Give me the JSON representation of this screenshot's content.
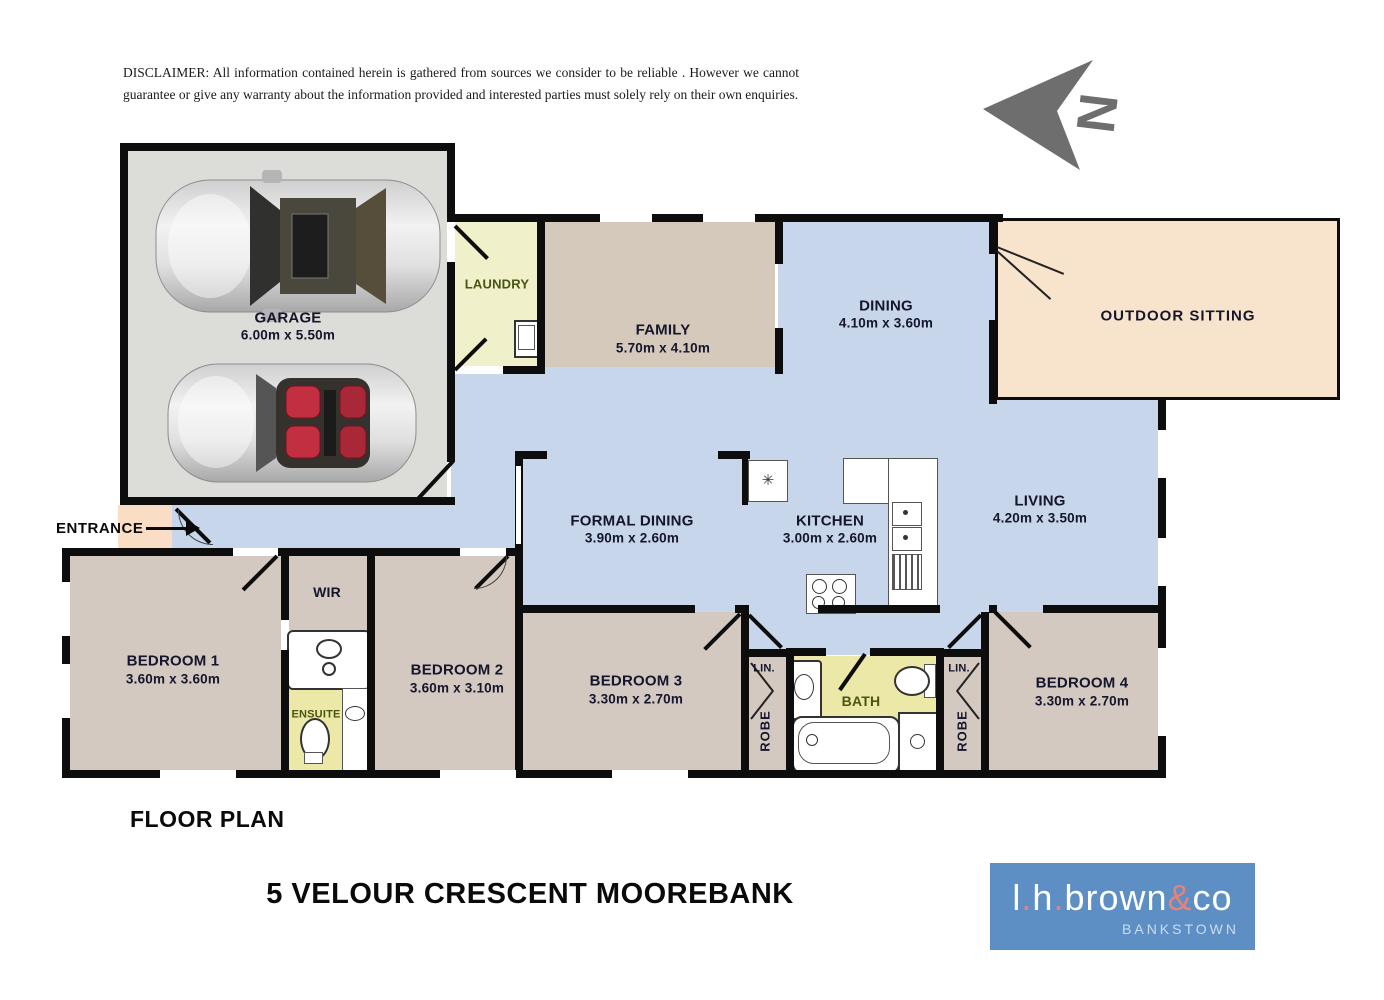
{
  "disclaimer": {
    "text": "DISCLAIMER:  All information contained herein is gathered from sources we consider to be reliable . However we cannot guarantee or give any warranty about the information provided and interested parties must solely rely on their own enquiries."
  },
  "north": {
    "label": "N"
  },
  "rooms": {
    "garage": {
      "name": "GARAGE",
      "dims": "6.00m x 5.50m"
    },
    "laundry": {
      "name": "LAUNDRY"
    },
    "family": {
      "name": "FAMILY",
      "dims": "5.70m x 4.10m"
    },
    "dining": {
      "name": "DINING",
      "dims": "4.10m x 3.60m"
    },
    "outdoor": {
      "name": "OUTDOOR SITTING"
    },
    "living": {
      "name": "LIVING",
      "dims": "4.20m x 3.50m"
    },
    "formal_dining": {
      "name": "FORMAL DINING",
      "dims": "3.90m x 2.60m"
    },
    "kitchen": {
      "name": "KITCHEN",
      "dims": "3.00m x 2.60m"
    },
    "entrance": {
      "name": "ENTRANCE"
    },
    "wir": {
      "name": "WIR"
    },
    "ensuite": {
      "name": "ENSUITE"
    },
    "bedroom1": {
      "name": "BEDROOM 1",
      "dims": "3.60m x 3.60m"
    },
    "bedroom2": {
      "name": "BEDROOM 2",
      "dims": "3.60m x 3.10m"
    },
    "bedroom3": {
      "name": "BEDROOM 3",
      "dims": "3.30m x 2.70m"
    },
    "bedroom4": {
      "name": "BEDROOM 4",
      "dims": "3.30m x 2.70m"
    },
    "bath": {
      "name": "BATH"
    },
    "lin_left": {
      "name": "LIN."
    },
    "lin_right": {
      "name": "LIN."
    },
    "robe_left": {
      "name": "ROBE"
    },
    "robe_right": {
      "name": "ROBE"
    }
  },
  "footer": {
    "plan_label": "FLOOR PLAN",
    "address": "5 VELOUR CRESCENT  MOOREBANK"
  },
  "logo": {
    "parts": [
      "l",
      ".",
      "h",
      ".",
      "brown",
      "&",
      "co"
    ],
    "suburb": "BANKSTOWN"
  },
  "colors": {
    "blue_floor": "#c7d6eb",
    "beige_floor": "#d3c9c0",
    "family_floor": "#d5c9bc",
    "garage_floor": "#dcdcd8",
    "laundry_floor": "#f0f0ca",
    "bath_floor": "#ece8a8",
    "outdoor_floor": "#f8e4cc",
    "porch_floor": "#f9dec5",
    "wall": "#0d0d0d",
    "label": "#15152c",
    "olive": "#4b5513",
    "logo_bg": "#5e8fc4",
    "logo_accent": "#e5837a",
    "logo_suburb": "#c9dcf0",
    "north": "#6e6e6e"
  }
}
